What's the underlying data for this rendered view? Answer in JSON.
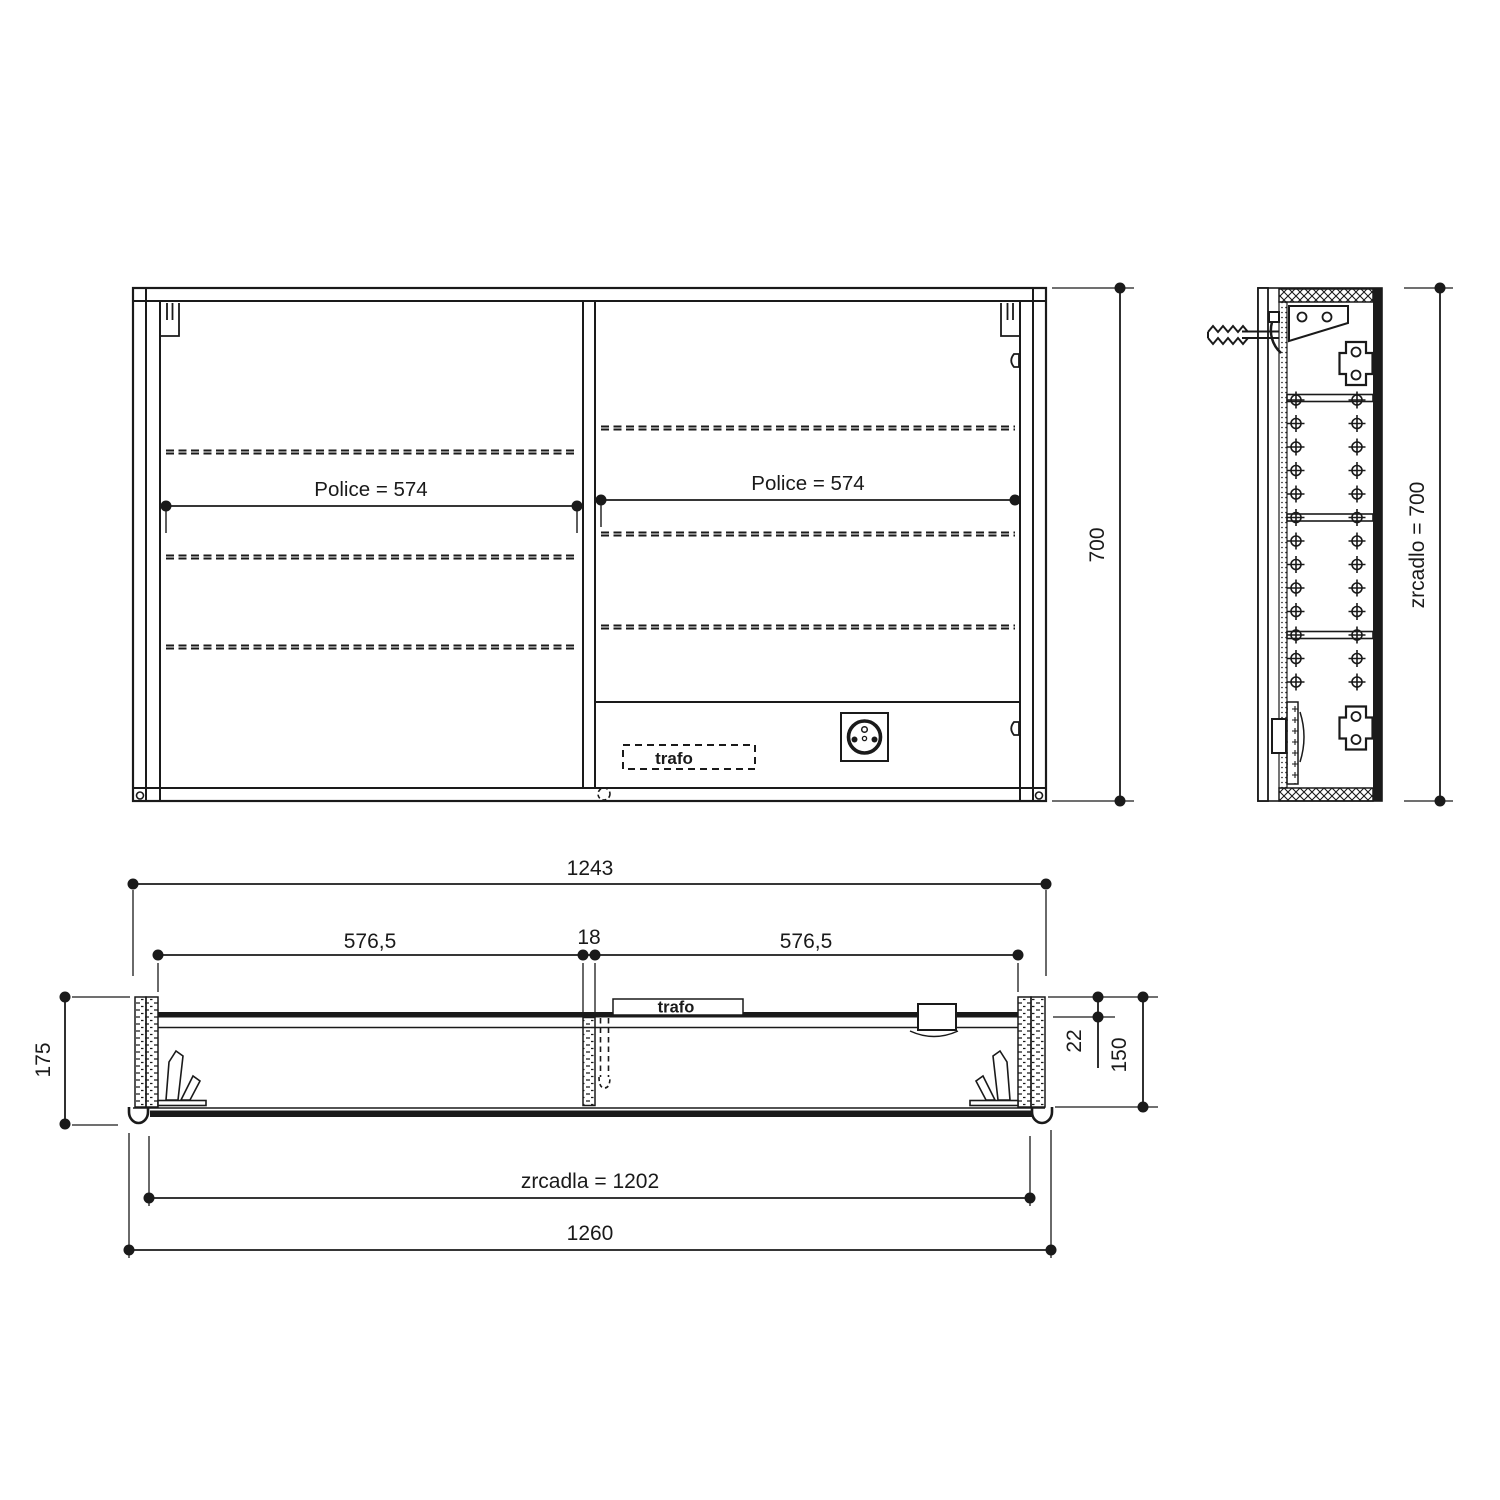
{
  "views": {
    "front": {
      "police_left": "Police = 574",
      "police_right": "Police = 574",
      "trafo": "trafo",
      "dim_height": "700"
    },
    "side": {
      "dim_height": "zrcadlo = 700"
    },
    "plan": {
      "dim_width_body": "1243",
      "dim_left_door": "576,5",
      "dim_divider": "18",
      "dim_right_door": "576,5",
      "dim_depth_overall": "175",
      "dim_back_offset": "22",
      "dim_depth_body": "150",
      "dim_mirror_width": "zrcadla = 1202",
      "dim_width_overall": "1260",
      "trafo": "trafo"
    }
  },
  "colors": {
    "ink": "#1a1a1a",
    "paper": "#ffffff"
  }
}
